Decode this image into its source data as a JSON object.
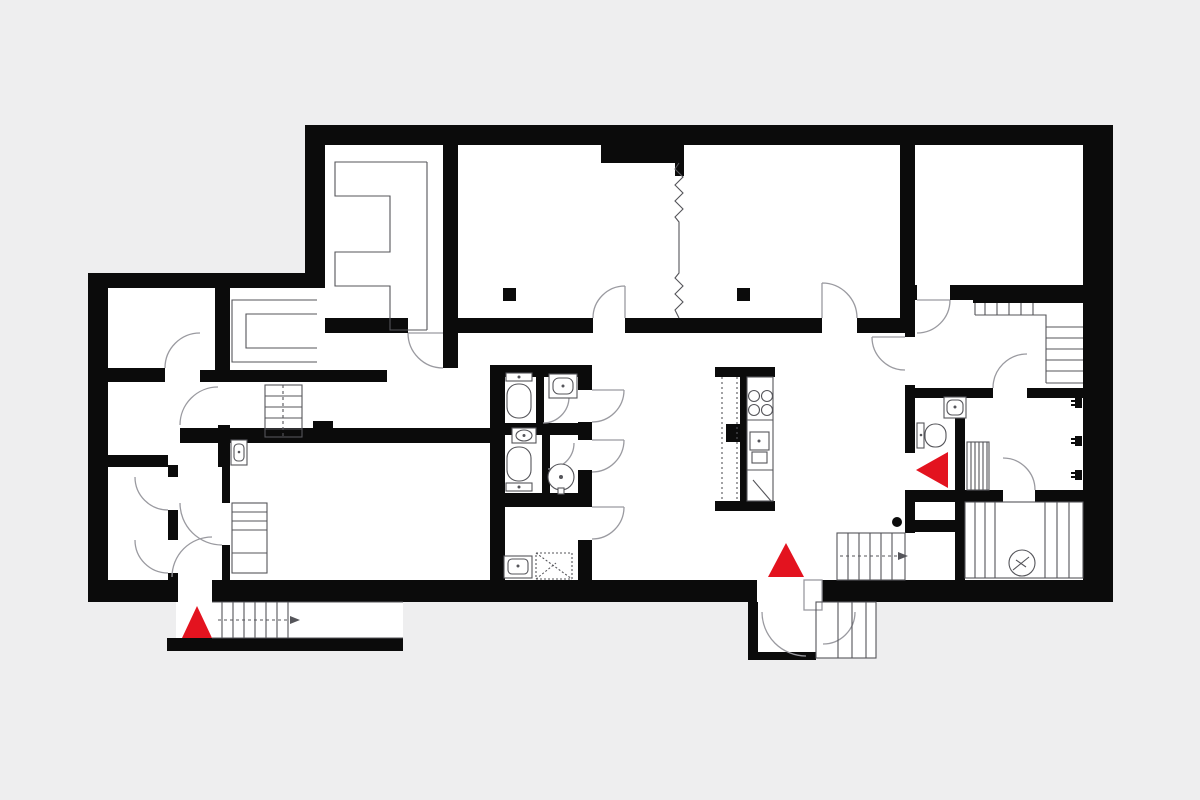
{
  "colors": {
    "background": "#eeeeef",
    "floor": "#ffffff",
    "wall": "#0b0b0b",
    "door_line": "#9a9aa0",
    "detail_line": "#55555a",
    "accent": "#e3131f"
  },
  "plan": {
    "kind": "residential-floor-plan",
    "entrance_markers": [
      {
        "name": "west-entrance-arrow",
        "direction": "up"
      },
      {
        "name": "south-entrance-arrow",
        "direction": "up"
      },
      {
        "name": "east-entrance-arrow",
        "direction": "left"
      }
    ],
    "fixture_counts": {
      "toilets": 3,
      "washbasins": 7,
      "washing_machine": 1,
      "cooktop_burners": 4,
      "staircases": 6,
      "radiators": 1,
      "electric_meter": 1,
      "wardrobes": 2,
      "columns": 3
    }
  }
}
